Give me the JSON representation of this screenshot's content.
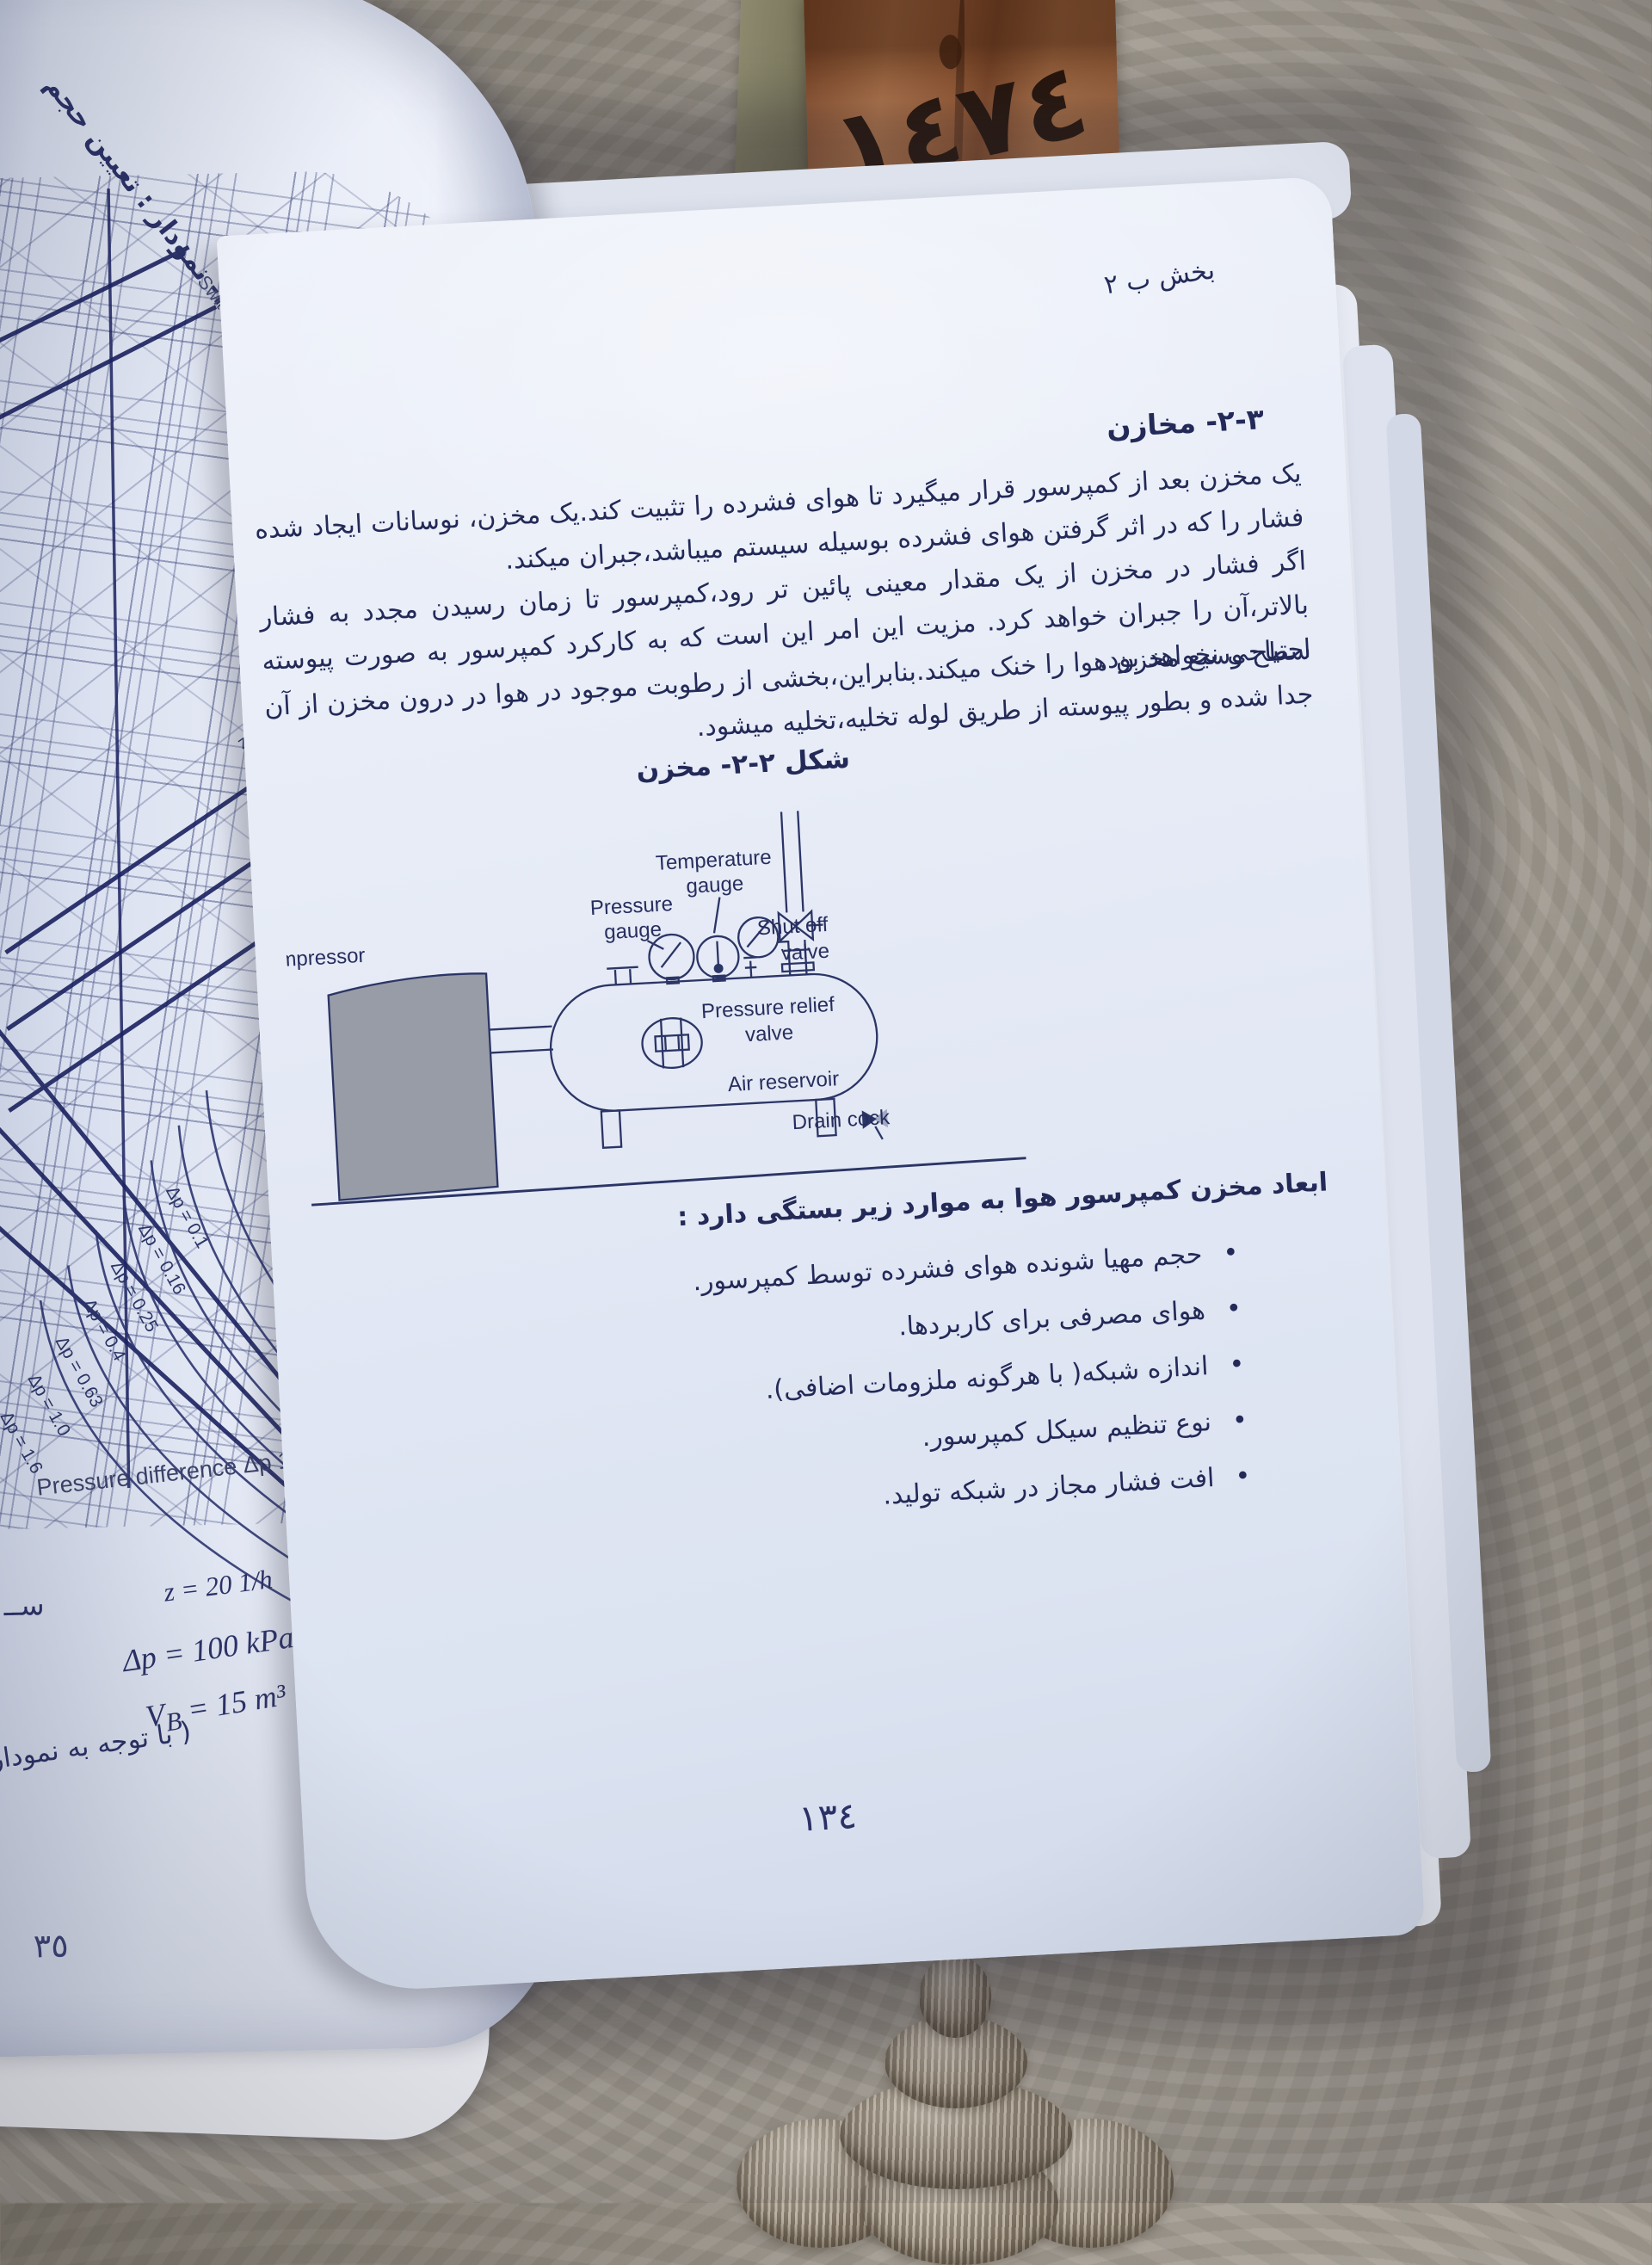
{
  "scene": {
    "bookmark_number": "١٤٧٤",
    "colors": {
      "ink": "#2a3166",
      "page": "#e8ecf6",
      "bookmark_leather": "#a3623a",
      "wallpaper": "#a29c92"
    }
  },
  "left_page": {
    "figure_caption": "شکل ٣-٢- نمودار : تعیین حجم",
    "switching_label": "Switching cycles",
    "z_labels": [
      "z = 10",
      "z = 15",
      "z = 20"
    ],
    "dp_labels": [
      "Δp = 0.1",
      "Δp = 0.16",
      "Δp = 0.25",
      "Δp = 0.4",
      "Δp = 0.63",
      "Δp = 1.0",
      "Δp = 1.6"
    ],
    "axis_prefix": "Pressure difference Δp 10",
    "axis_exp": "2",
    "axis_unit": " kPa bar",
    "annotations": {
      "z": "z = 20 1/h",
      "dp": "Δp = 100 kPa",
      "vb_var": "V",
      "vb_sub": "B",
      "vb_value": " = 15 m³",
      "note": "( با توجه به نمودار )"
    },
    "fragment": "ســ",
    "page_number_partial": "٣٥"
  },
  "right_page": {
    "header": "بخش ب ٢",
    "section_heading": "٣-٢- مخازن",
    "paragraph1": "یک مخزن بعد از کمپرسور قرار میگیرد تا هوای فشرده را تثبیت کند.یک مخزن، نوسانات ایجاد شده فشار را که در اثر گرفتن هوای فشرده بوسیله سیستم میباشد،جبران میکند.",
    "paragraph2": "اگر فشار در مخزن از یک مقدار معینی پائین تر رود،کمپرسور تا زمان رسیدن مجدد به فشار بالاتر،آن را جبران خواهد کرد. مزیت این امر این است که به کارکرد کمپرسور به صورت پیوسته احتیاجی نخواهد بود.",
    "paragraph3": "سطح وسیع مخزن هوا را خنک میکند.بنابراین،بخشی از رطوبت موجود در هوا در درون مخزن از آن جدا شده و بطور پیوسته از طریق لوله تخلیه،تخلیه میشود.",
    "figure_caption": "شکل ٢-٢- مخزن",
    "figure_labels": {
      "compressor": "Compressor",
      "pressure_l1": "Pressure",
      "pressure_l2": "gauge",
      "temperature_l1": "Temperature",
      "temperature_l2": "gauge",
      "shutoff_l1": "Shut off",
      "shutoff_l2": "valve",
      "relief_l1": "Pressure relief",
      "relief_l2": "valve",
      "air_reservoir": "Air reservoir",
      "drain_cock": "Drain cock"
    },
    "list_intro": "ابعاد مخزن کمپرسور هوا به موارد زیر بستگی دارد :",
    "list_items": [
      "حجم مهیا شونده هوای فشرده توسط کمپرسور.",
      "هوای مصرفی برای کاربردها.",
      "اندازه شبکه( با هرگونه ملزومات اضافی).",
      "نوع تنظیم سیکل کمپرسور.",
      "افت فشار مجاز در شبکه تولید."
    ],
    "page_number": "١٣٤"
  }
}
